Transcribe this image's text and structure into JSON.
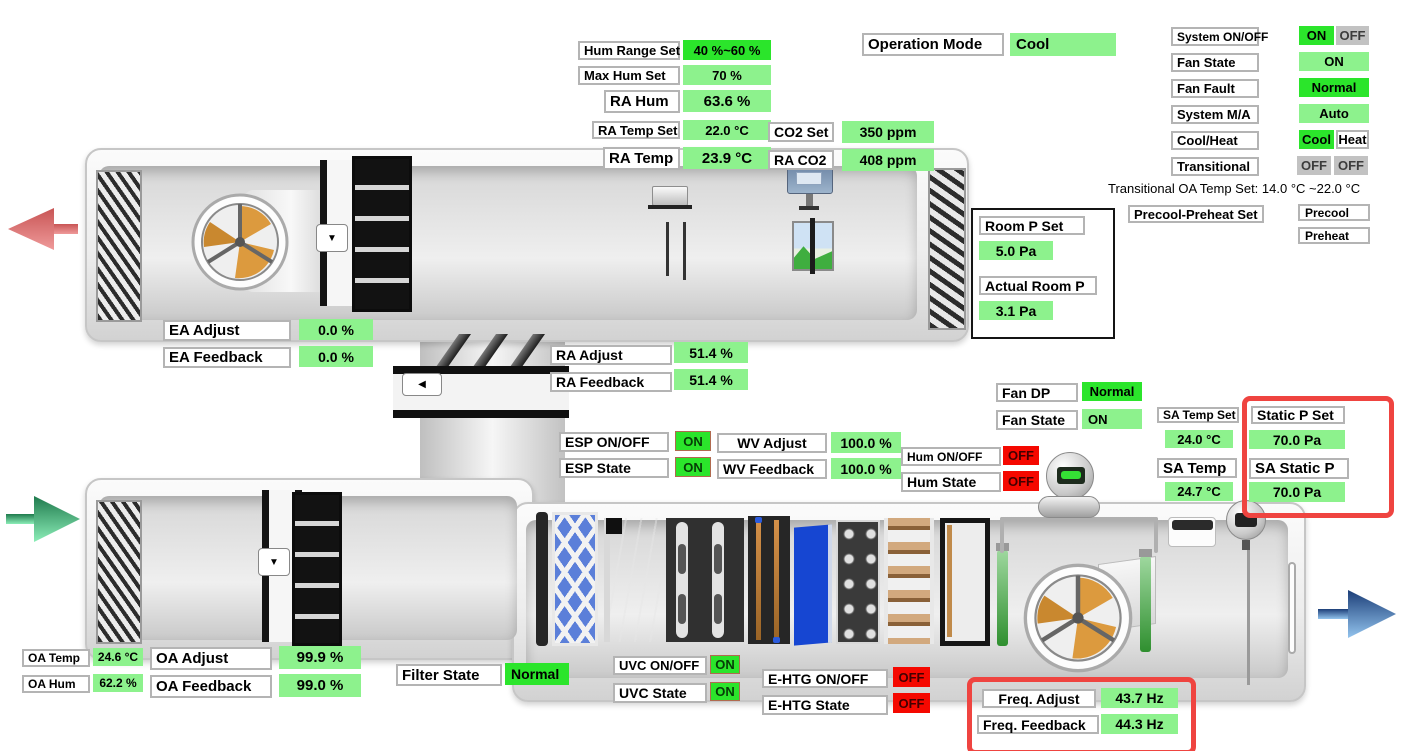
{
  "title": "AHU HMI Overview",
  "colors": {
    "bright_green": "#2BE52B",
    "light_green": "#8DF28D",
    "alarm_red": "#F50800",
    "inactive_gray": "#C2C2C2",
    "highlight_red": "#EF4440",
    "exhaust_arrow": "#DC7070",
    "outdoor_arrow": "#49C27E",
    "supply_arrow": "#5E96D8"
  },
  "icons": {
    "damper_actuator_down": "▼",
    "damper_actuator_left": "◀"
  },
  "f": {
    "hum_range_set": {
      "label": "Hum Range Set",
      "value": "40 %~60 %"
    },
    "max_hum_set": {
      "label": "Max Hum Set",
      "value": "70 %"
    },
    "ra_hum": {
      "label": "RA Hum",
      "value": "63.6 %"
    },
    "ra_temp_set": {
      "label": "RA Temp Set",
      "value": "22.0 °C"
    },
    "ra_temp": {
      "label": "RA Temp",
      "value": "23.9 °C"
    },
    "co2_set": {
      "label": "CO2 Set",
      "value": "350 ppm"
    },
    "ra_co2": {
      "label": "RA CO2",
      "value": "408 ppm"
    },
    "operation_mode": {
      "label": "Operation Mode",
      "value": "Cool"
    },
    "system_on_off": {
      "label": "System ON/OFF",
      "on": "ON",
      "off": "OFF"
    },
    "fan_state_top": {
      "label": "Fan State",
      "value": "ON"
    },
    "fan_fault": {
      "label": "Fan Fault",
      "value": "Normal"
    },
    "system_ma": {
      "label": "System M/A",
      "value": "Auto"
    },
    "cool_heat": {
      "label": "Cool/Heat",
      "cool": "Cool",
      "heat": "Heat"
    },
    "transitional": {
      "label": "Transitional",
      "left": "OFF",
      "right": "OFF"
    },
    "transitional_note": "Transitional OA Temp Set: 14.0 °C ~22.0 °C",
    "precool_preheat_set": {
      "label": "Precool-Preheat Set",
      "precool": "Precool",
      "preheat": "Preheat"
    },
    "room_p_set": {
      "label": "Room P Set",
      "value": "5.0 Pa"
    },
    "actual_room_p": {
      "label": "Actual Room P",
      "value": "3.1 Pa"
    },
    "ea_adjust": {
      "label": "EA Adjust",
      "value": "0.0 %"
    },
    "ea_feedback": {
      "label": "EA Feedback",
      "value": "0.0 %"
    },
    "ra_adjust": {
      "label": "RA Adjust",
      "value": "51.4 %"
    },
    "ra_feedback": {
      "label": "RA Feedback",
      "value": "51.4 %"
    },
    "fan_dp": {
      "label": "Fan DP",
      "value": "Normal"
    },
    "fan_state": {
      "label": "Fan State",
      "value": "ON"
    },
    "sa_temp_set": {
      "label": "SA Temp Set",
      "value": "24.0 °C"
    },
    "sa_temp": {
      "label": "SA Temp",
      "value": "24.7 °C"
    },
    "static_p_set": {
      "label": "Static P Set",
      "value": "70.0 Pa"
    },
    "sa_static_p": {
      "label": "SA Static P",
      "value": "70.0 Pa"
    },
    "esp_on_off": {
      "label": "ESP ON/OFF",
      "value": "ON"
    },
    "esp_state": {
      "label": "ESP State",
      "value": "ON"
    },
    "wv_adjust": {
      "label": "WV Adjust",
      "value": "100.0 %"
    },
    "wv_feedback": {
      "label": "WV Feedback",
      "value": "100.0 %"
    },
    "hum_on_off": {
      "label": "Hum ON/OFF",
      "value": "OFF"
    },
    "hum_state": {
      "label": "Hum State",
      "value": "OFF"
    },
    "oa_temp": {
      "label": "OA Temp",
      "value": "24.6 °C"
    },
    "oa_hum": {
      "label": "OA Hum",
      "value": "62.2 %"
    },
    "oa_adjust": {
      "label": "OA Adjust",
      "value": "99.9 %"
    },
    "oa_feedback": {
      "label": "OA Feedback",
      "value": "99.0 %"
    },
    "filter_state": {
      "label": "Filter State",
      "value": "Normal"
    },
    "uvc_on_off": {
      "label": "UVC ON/OFF",
      "value": "ON"
    },
    "uvc_state": {
      "label": "UVC State",
      "value": "ON"
    },
    "e_htg_on_off": {
      "label": "E-HTG ON/OFF",
      "value": "OFF"
    },
    "e_htg_state": {
      "label": "E-HTG State",
      "value": "OFF"
    },
    "freq_adjust": {
      "label": "Freq. Adjust",
      "value": "43.7 Hz"
    },
    "freq_feedback": {
      "label": "Freq. Feedback",
      "value": "44.3 Hz"
    }
  }
}
